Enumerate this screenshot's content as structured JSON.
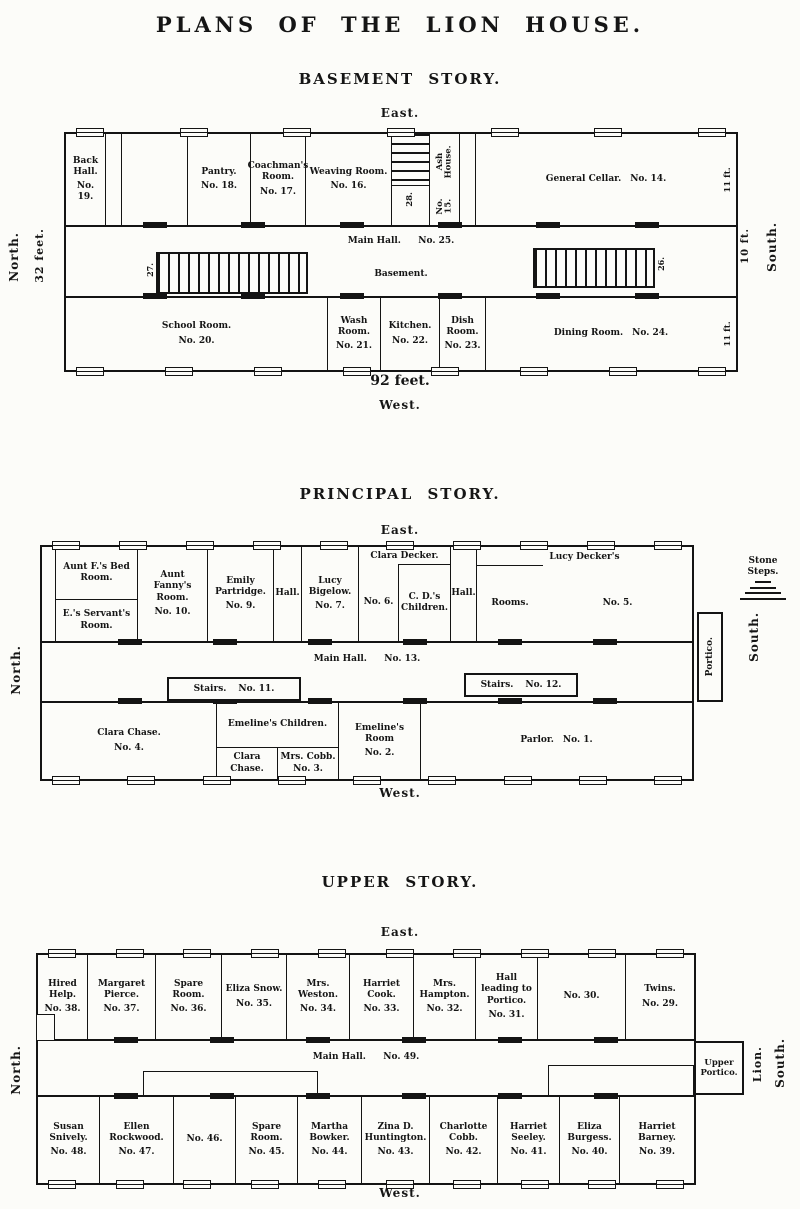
{
  "page_title": "PLANS OF THE LION HOUSE.",
  "basement": {
    "title": "BASEMENT STORY.",
    "east": "East.",
    "west": "West.",
    "north": "North.",
    "south": "South.",
    "length": "92 feet.",
    "width": "32 feet.",
    "hall_width": "10 ft.",
    "north_row_depth": "11 ft.",
    "south_row_depth": "11 ft.",
    "rooms": {
      "back_hall": {
        "label": "Back Hall.",
        "num": "No. 19."
      },
      "pantry": {
        "label": "Pantry.",
        "num": "No. 18."
      },
      "coachman": {
        "label": "Coachman's Room.",
        "num": "No. 17."
      },
      "weaving": {
        "label": "Weaving Room.",
        "num": "No. 16."
      },
      "stairs_top": {
        "num": "28."
      },
      "ash_house": {
        "label": "Ash House.",
        "num": "No. 15."
      },
      "general_cellar": {
        "label": "General Cellar.",
        "num": "No. 14."
      },
      "main_hall": {
        "label": "Main Hall.",
        "num": "No. 25.",
        "sub": "Basement."
      },
      "stairs_left": {
        "num": "27."
      },
      "stairs_right": {
        "num": "26."
      },
      "school": {
        "label": "School Room.",
        "num": "No. 20."
      },
      "wash": {
        "label": "Wash Room.",
        "num": "No. 21."
      },
      "kitchen": {
        "label": "Kitchen.",
        "num": "No. 22."
      },
      "dish": {
        "label": "Dish Room.",
        "num": "No. 23."
      },
      "dining": {
        "label": "Dining Room.",
        "num": "No. 24."
      }
    }
  },
  "principal": {
    "title": "PRINCIPAL STORY.",
    "east": "East.",
    "west": "West.",
    "north": "North.",
    "south": "South.",
    "stone_steps": "Stone Steps.",
    "portico": "Portico.",
    "rooms": {
      "aunt_f_bed": {
        "label": "Aunt F.'s Bed Room."
      },
      "e_servant": {
        "label": "E.'s Servant's Room."
      },
      "aunt_fanny": {
        "label": "Aunt Fanny's Room.",
        "num": "No. 10."
      },
      "emily_partridge": {
        "label": "Emily Partridge.",
        "num": "No. 9."
      },
      "hall_1": {
        "label": "Hall."
      },
      "lucy_bigelow": {
        "label": "Lucy Bigelow.",
        "num": "No. 7."
      },
      "clara_decker": {
        "label": "Clara Decker.",
        "num": "No. 6."
      },
      "cd_children": {
        "label": "C. D.'s Children."
      },
      "hall_2": {
        "label": "Hall."
      },
      "lucy_decker": {
        "label": "Lucy Decker's",
        "rooms": "Rooms.",
        "num": "No. 5."
      },
      "main_hall": {
        "label": "Main Hall.",
        "num": "No. 13."
      },
      "stairs_11": {
        "label": "Stairs.",
        "num": "No. 11."
      },
      "stairs_12": {
        "label": "Stairs.",
        "num": "No. 12."
      },
      "clara_chase": {
        "label": "Clara Chase.",
        "num": "No. 4."
      },
      "emeline_children": {
        "label": "Emeline's Children."
      },
      "clara_chase_small": {
        "label": "Clara Chase."
      },
      "mrs_cobb": {
        "label": "Mrs. Cobb.",
        "num": "No. 3."
      },
      "emeline_room": {
        "label": "Emeline's Room",
        "num": "No. 2."
      },
      "parlor": {
        "label": "Parlor.",
        "num": "No. 1."
      }
    }
  },
  "upper": {
    "title": "UPPER STORY.",
    "east": "East.",
    "west": "West.",
    "north": "North.",
    "south": "South.",
    "lion": "Lion.",
    "upper_portico": "Upper Portico.",
    "rooms": {
      "hired_help": {
        "label": "Hired Help.",
        "num": "No. 38."
      },
      "margaret_pierce": {
        "label": "Margaret Pierce.",
        "num": "No. 37."
      },
      "spare_36": {
        "label": "Spare Room.",
        "num": "No. 36."
      },
      "eliza_snow": {
        "label": "Eliza Snow.",
        "num": "No. 35."
      },
      "mrs_weston": {
        "label": "Mrs. Weston.",
        "num": "No. 34."
      },
      "harriet_cook": {
        "label": "Harriet Cook.",
        "num": "No. 33."
      },
      "mrs_hampton": {
        "label": "Mrs. Hampton.",
        "num": "No. 32."
      },
      "hall_portico": {
        "label": "Hall leading to Portico.",
        "num": "No. 31."
      },
      "room_30": {
        "num": "No. 30."
      },
      "twins": {
        "label": "Twins.",
        "num": "No. 29."
      },
      "main_hall": {
        "label": "Main Hall.",
        "num": "No. 49."
      },
      "susan_snively": {
        "label": "Susan Snively.",
        "num": "No. 48."
      },
      "ellen_rockwood": {
        "label": "Ellen Rockwood.",
        "num": "No. 47."
      },
      "room_46": {
        "num": "No. 46."
      },
      "spare_45": {
        "label": "Spare Room.",
        "num": "No. 45."
      },
      "martha_bowker": {
        "label": "Martha Bowker.",
        "num": "No. 44."
      },
      "zina_huntington": {
        "label": "Zina D. Huntington.",
        "num": "No. 43."
      },
      "charlotte_cobb": {
        "label": "Charlotte Cobb.",
        "num": "No. 42."
      },
      "harriet_seeley": {
        "label": "Harriet Seeley.",
        "num": "No. 41."
      },
      "eliza_burgess": {
        "label": "Eliza Burgess.",
        "num": "No. 40."
      },
      "harriet_barney": {
        "label": "Harriet Barney.",
        "num": "No. 39."
      }
    }
  }
}
